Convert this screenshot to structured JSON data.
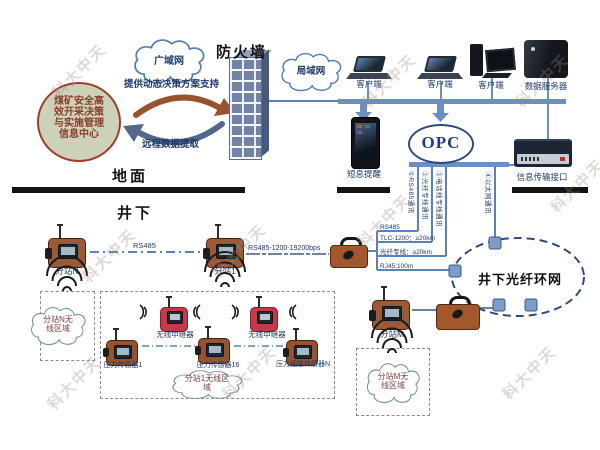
{
  "surface": {
    "wan_cloud": "广域网",
    "firewall_title": "防火墙",
    "lan_cloud": "局域网",
    "decision_center": "煤矿安全高效开采决策与实施管理信息中心",
    "support_arrow": "提供动态决策方案支持",
    "extract_arrow": "远程数据提取",
    "ground_label": "地面",
    "clients": [
      "客户端",
      "客户端",
      "客户端"
    ],
    "data_server": "数据服务器",
    "sms_alert": "短息提醒",
    "opc": "OPC",
    "info_interface": "信息传输接口"
  },
  "underground": {
    "title": "井下",
    "comm_links": [
      "①RS485通讯",
      "②光纤专线通讯",
      "③电话线专线通讯",
      "④以太网通讯"
    ],
    "link_specs": [
      "RS485",
      "TLC-1200：≥20km",
      "光纤专线：≥20km",
      "RJ45:100m"
    ],
    "rs485_label": "RS485",
    "rs485_bps_label": "RS485-1200-19200bps",
    "stations": [
      "分站N",
      "分站1",
      "分站M"
    ],
    "fiber_ring": "井下光纤环网",
    "repeaters": [
      "无线中继器",
      "无线中继器"
    ],
    "sensors": [
      "压力传感器1",
      "压力传感器16",
      "压力细量传感器N"
    ],
    "zones": [
      "分站N无线区域",
      "分站1无线区域",
      "分站M无线区域"
    ]
  },
  "watermark": "科大中天",
  "colors": {
    "line_blue": "#5b82b8",
    "bus_blue": "#6d8fc0",
    "navy_text": "#1d3a6b",
    "circle_fill": "#ccd2b8",
    "circle_border": "#a23b2c",
    "arrow_brown": "#96532e",
    "arrow_slate": "#53688c",
    "device_brown": "#9a5a38",
    "repeater_red": "#c53a4a",
    "ring_navy": "#2e4a7a"
  }
}
